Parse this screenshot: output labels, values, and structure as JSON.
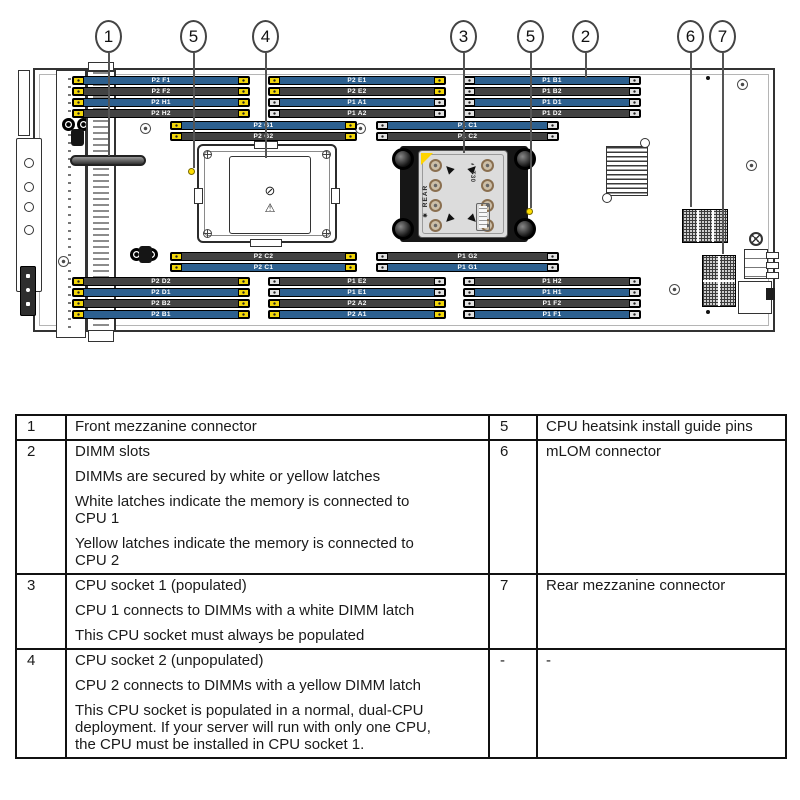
{
  "colors": {
    "dimm_blue": "#2d608f",
    "dimm_dark": "#424242",
    "latch_yellow": "#f2d60a",
    "latch_white": "#e2e2e2",
    "warning_yellow": "#ffd400",
    "screw_copper": "#8a6f50",
    "line": "#555555",
    "board_border": "#333333"
  },
  "diagram": {
    "callouts": [
      "1",
      "5",
      "4",
      "3",
      "5",
      "2",
      "6",
      "7"
    ],
    "dimm_blocks": {
      "top_left": [
        {
          "label": "P2 F1",
          "tone": "blue",
          "latch": "yellow"
        },
        {
          "label": "P2 F2",
          "tone": "dark",
          "latch": "yellow"
        },
        {
          "label": "P2 H1",
          "tone": "blue",
          "latch": "yellow"
        },
        {
          "label": "P2 H2",
          "tone": "dark",
          "latch": "yellow"
        }
      ],
      "top_mid": [
        {
          "label": "P2 E1",
          "tone": "blue",
          "latch": "yellow"
        },
        {
          "label": "P2 E2",
          "tone": "dark",
          "latch": "yellow"
        },
        {
          "label": "P1 A1",
          "tone": "blue",
          "latch": "white"
        },
        {
          "label": "P1 A2",
          "tone": "dark",
          "latch": "white"
        }
      ],
      "top_right": [
        {
          "label": "P1 B1",
          "tone": "blue",
          "latch": "white"
        },
        {
          "label": "P1 B2",
          "tone": "dark",
          "latch": "white"
        },
        {
          "label": "P1 D1",
          "tone": "blue",
          "latch": "white"
        },
        {
          "label": "P1 D2",
          "tone": "dark",
          "latch": "white"
        }
      ],
      "mid_upper_left": [
        {
          "label": "P2 G1",
          "tone": "blue",
          "latch": "yellow"
        },
        {
          "label": "P2 G2",
          "tone": "dark",
          "latch": "yellow"
        }
      ],
      "mid_upper_right": [
        {
          "label": "P1 C1",
          "tone": "blue",
          "latch": "white"
        },
        {
          "label": "P1 C2",
          "tone": "dark",
          "latch": "white"
        }
      ],
      "mid_lower_left": [
        {
          "label": "P2 C2",
          "tone": "dark",
          "latch": "yellow"
        },
        {
          "label": "P2 C1",
          "tone": "blue",
          "latch": "yellow"
        }
      ],
      "mid_lower_right": [
        {
          "label": "P1 G2",
          "tone": "dark",
          "latch": "white"
        },
        {
          "label": "P1 G1",
          "tone": "blue",
          "latch": "white"
        }
      ],
      "bottom_left": [
        {
          "label": "P2 D2",
          "tone": "dark",
          "latch": "yellow"
        },
        {
          "label": "P2 D1",
          "tone": "blue",
          "latch": "yellow"
        },
        {
          "label": "P2 B2",
          "tone": "dark",
          "latch": "yellow"
        },
        {
          "label": "P2 B1",
          "tone": "blue",
          "latch": "yellow"
        }
      ],
      "bottom_mid": [
        {
          "label": "P1 E2",
          "tone": "dark",
          "latch": "white"
        },
        {
          "label": "P1 E1",
          "tone": "blue",
          "latch": "white"
        },
        {
          "label": "P2 A2",
          "tone": "dark",
          "latch": "yellow"
        },
        {
          "label": "P2 A1",
          "tone": "blue",
          "latch": "yellow"
        }
      ],
      "bottom_right": [
        {
          "label": "P1 H2",
          "tone": "dark",
          "latch": "white"
        },
        {
          "label": "P1 H1",
          "tone": "blue",
          "latch": "white"
        },
        {
          "label": "P1 F2",
          "tone": "dark",
          "latch": "white"
        },
        {
          "label": "P1 F1",
          "tone": "blue",
          "latch": "white"
        }
      ]
    },
    "heatsink": {
      "torx_label": "T30",
      "rear_label": "REAR",
      "rear_icon": "✷"
    },
    "socket2": {
      "screw_icon": "⊘",
      "warning_icon": "⚠︎"
    }
  },
  "table": {
    "rows": [
      {
        "num_left": "1",
        "desc_left": [
          "Front mezzanine connector"
        ],
        "num_right": "5",
        "desc_right": [
          "CPU heatsink install guide pins"
        ]
      },
      {
        "num_left": "2",
        "desc_left": [
          "DIMM slots",
          "DIMMs are secured by white or yellow latches",
          "White latches indicate the memory is connected to CPU 1",
          "Yellow latches indicate the memory is connected to CPU 2"
        ],
        "num_right": "6",
        "desc_right": [
          "mLOM connector"
        ]
      },
      {
        "num_left": "3",
        "desc_left": [
          "CPU socket 1 (populated)",
          "CPU 1 connects to DIMMs with a white DIMM latch",
          "This CPU socket must always be populated"
        ],
        "num_right": "7",
        "desc_right": [
          "Rear mezzanine connector"
        ]
      },
      {
        "num_left": "4",
        "desc_left": [
          "CPU socket 2 (unpopulated)",
          "CPU 2 connects to DIMMs with a yellow DIMM latch",
          "This CPU socket is populated in a normal, dual-CPU deployment. If your server will run with only one CPU, the CPU must be installed in CPU socket 1."
        ],
        "num_right": "-",
        "desc_right": [
          "-"
        ]
      }
    ]
  }
}
